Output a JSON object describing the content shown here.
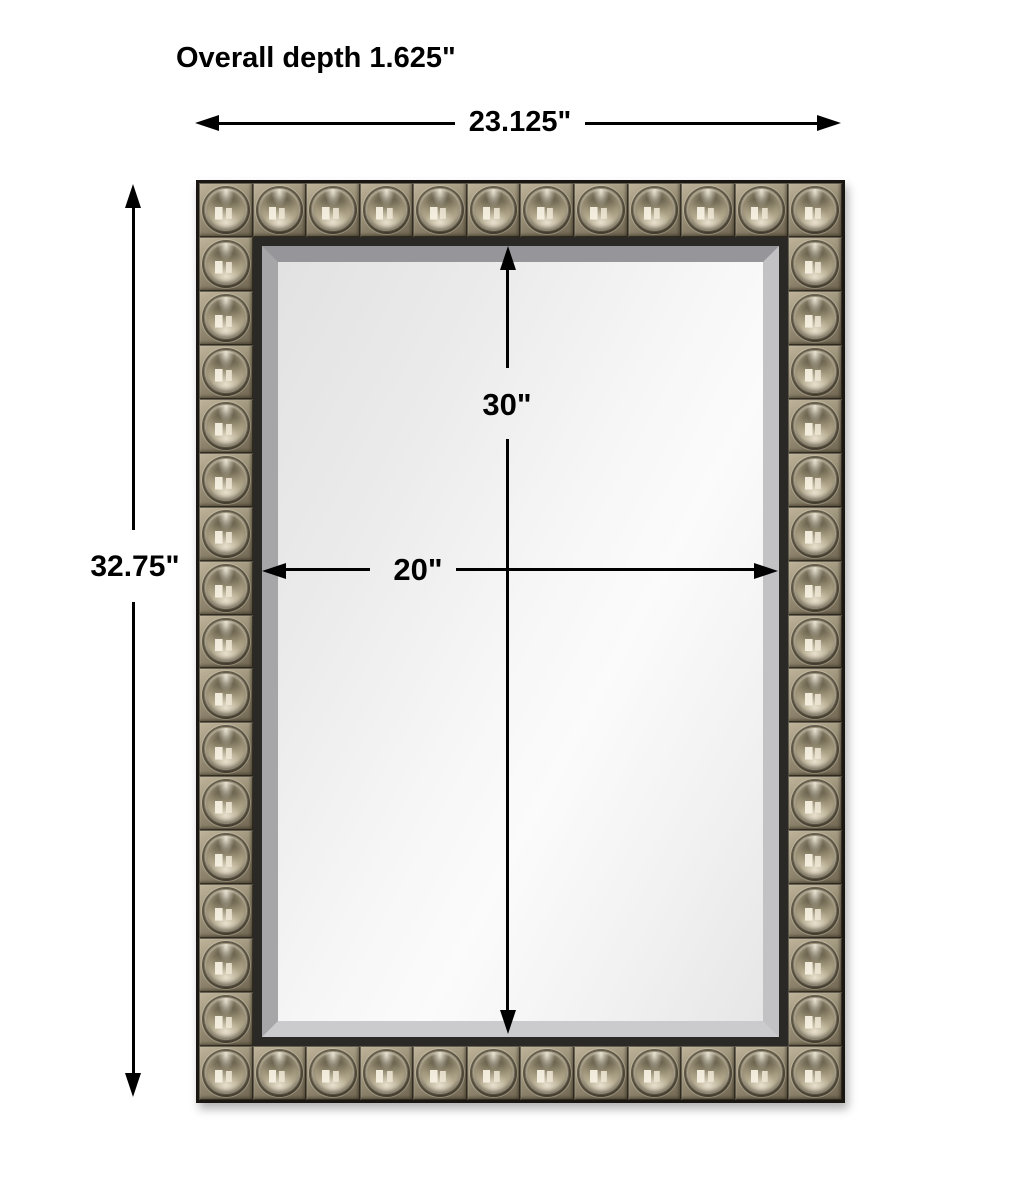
{
  "title": "Mirror dimension diagram",
  "labels": {
    "overall_depth": "Overall depth 1.625\"",
    "overall_width": "23.125\"",
    "overall_height": "32.75\"",
    "mirror_height": "30\"",
    "mirror_width": "20\""
  },
  "dimensions": {
    "overall_depth_in": 1.625,
    "overall_width_in": 23.125,
    "overall_height_in": 32.75,
    "mirror_height_in": 30,
    "mirror_width_in": 20
  },
  "mirror": {
    "frame_style": "beaded-square-tiles",
    "tiles_across": 12,
    "tiles_down": 17
  },
  "colors": {
    "page_bg": "#ffffff",
    "dim_line": "#000000",
    "frame_edge": "#1a1712",
    "frame_lip": "#2b2925",
    "tile_base_light": "#c0b59b",
    "tile_base_dark": "#6e6450",
    "metal_highlight": "#f2ebd8",
    "metal_mid": "#a89d82",
    "metal_shadow": "#4e4735",
    "bevel_gray": "#a8a8aa",
    "glass_light": "#fbfbfb",
    "glass_dark": "#e2e2e2"
  }
}
